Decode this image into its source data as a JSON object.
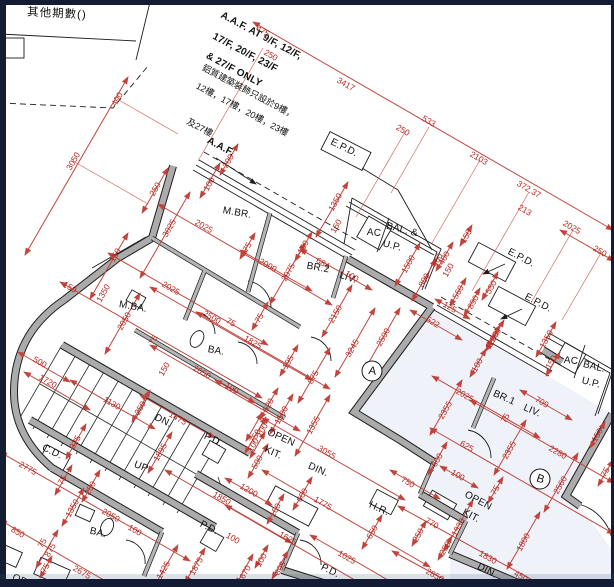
{
  "drawing": {
    "type": "architectural floor plan",
    "other_phases_title": "其他期數()",
    "colors": {
      "dimension_red": "#c0443c",
      "wall_gray": "#ababab",
      "frame_navy": "#131c33",
      "unit_b_tint": "#e9eef5"
    }
  },
  "labels": [
    {
      "name": "other-phases-title",
      "text": "其他期數()",
      "x": 57,
      "y": 13,
      "r": 3,
      "cls": "title"
    },
    {
      "name": "aaf-note-line1",
      "text": "A.A.F. AT 9/F, 12/F,",
      "x": 216,
      "y": 36,
      "r": 28,
      "cls": "note",
      "anchor": "l"
    },
    {
      "name": "aaf-note-line2",
      "text": "17/F, 20/F, 23/F",
      "x": 209,
      "y": 53,
      "r": 28,
      "cls": "note",
      "anchor": "l"
    },
    {
      "name": "aaf-note-line3",
      "text": "& 27/F ONLY",
      "x": 203,
      "y": 70,
      "r": 28,
      "cls": "note",
      "anchor": "l"
    },
    {
      "name": "aaf-note-cn1",
      "text": "鋁質建築裝飾只設於9樓，",
      "x": 197,
      "y": 91,
      "r": 28,
      "cls": "cn",
      "anchor": "l"
    },
    {
      "name": "aaf-note-cn2",
      "text": "12樓，17樓，20樓，23樓",
      "x": 191,
      "y": 109,
      "r": 28,
      "cls": "cn",
      "anchor": "l"
    },
    {
      "name": "aaf-note-cn3",
      "text": "及27樓",
      "x": 186,
      "y": 127,
      "r": 28,
      "cls": "cn",
      "anchor": "l"
    },
    {
      "name": "aaf-label",
      "text": "A.A.F.",
      "x": 206,
      "y": 147,
      "r": 28,
      "cls": "note",
      "anchor": "l"
    },
    {
      "name": "epd-label-top",
      "text": "E.P.D.",
      "x": 344,
      "y": 148,
      "r": 26,
      "cls": "room"
    },
    {
      "name": "epd-label-mid",
      "text": "E.P.D.",
      "x": 521,
      "y": 258,
      "r": 28,
      "cls": "room"
    },
    {
      "name": "epd-label-low",
      "text": "E.P.D.",
      "x": 538,
      "y": 303,
      "r": 28,
      "cls": "room"
    },
    {
      "name": "room-mbr",
      "text": "M.BR.",
      "x": 237,
      "y": 213,
      "r": 10,
      "cls": "room"
    },
    {
      "name": "room-br2",
      "text": "BR.2",
      "x": 318,
      "y": 268,
      "r": 10,
      "cls": "room"
    },
    {
      "name": "room-liv-a",
      "text": "LIV.",
      "x": 348,
      "y": 278,
      "r": 18,
      "cls": "room"
    },
    {
      "name": "room-ac-a",
      "text": "AC",
      "x": 374,
      "y": 233,
      "r": 5,
      "cls": "room"
    },
    {
      "name": "room-bal-a1",
      "text": "BAL. &",
      "x": 402,
      "y": 230,
      "r": 14,
      "cls": "room"
    },
    {
      "name": "room-bal-a2",
      "text": "U.P.",
      "x": 392,
      "y": 246,
      "r": 14,
      "cls": "room"
    },
    {
      "name": "room-mba",
      "text": "M.BA.",
      "x": 133,
      "y": 307,
      "r": 10,
      "cls": "room"
    },
    {
      "name": "room-ba-a",
      "text": "BA.",
      "x": 216,
      "y": 351,
      "r": 10,
      "cls": "room"
    },
    {
      "name": "stairs-dn",
      "text": "DN.",
      "x": 163,
      "y": 421,
      "r": 26,
      "cls": "room"
    },
    {
      "name": "stairs-up",
      "text": "UP",
      "x": 141,
      "y": 467,
      "r": 22,
      "cls": "room"
    },
    {
      "name": "cd-label",
      "text": "C.D.",
      "x": 52,
      "y": 452,
      "r": 26,
      "cls": "room"
    },
    {
      "name": "pd-label-a",
      "text": "P.D.",
      "x": 213,
      "y": 440,
      "r": 26,
      "cls": "room"
    },
    {
      "name": "open-kit-a1",
      "text": "OPEN",
      "x": 281,
      "y": 438,
      "r": 24,
      "cls": "room"
    },
    {
      "name": "open-kit-a2",
      "text": "KIT.",
      "x": 273,
      "y": 453,
      "r": 24,
      "cls": "room"
    },
    {
      "name": "din-a",
      "text": "DIN.",
      "x": 318,
      "y": 470,
      "r": 24,
      "cls": "room"
    },
    {
      "name": "pd-label-b",
      "text": "P.D.",
      "x": 209,
      "y": 528,
      "r": 26,
      "cls": "room"
    },
    {
      "name": "hr-label",
      "text": "H.R.",
      "x": 379,
      "y": 509,
      "r": 24,
      "cls": "room"
    },
    {
      "name": "pd-label-c",
      "text": "P.D.",
      "x": 330,
      "y": 571,
      "r": 26,
      "cls": "room"
    },
    {
      "name": "open-kit-b1",
      "text": "OPEN",
      "x": 478,
      "y": 501,
      "r": 28,
      "cls": "room"
    },
    {
      "name": "open-kit-b2",
      "text": "KIT.",
      "x": 471,
      "y": 516,
      "r": 28,
      "cls": "room"
    },
    {
      "name": "din-b",
      "text": "DIN.",
      "x": 487,
      "y": 571,
      "r": 28,
      "cls": "room"
    },
    {
      "name": "room-br1",
      "text": "BR.1",
      "x": 504,
      "y": 398,
      "r": 24,
      "cls": "room"
    },
    {
      "name": "room-liv-b",
      "text": "LIV.",
      "x": 532,
      "y": 411,
      "r": 24,
      "cls": "room"
    },
    {
      "name": "room-ac-b",
      "text": "AC",
      "x": 571,
      "y": 361,
      "r": 5,
      "cls": "room"
    },
    {
      "name": "room-bal-b1",
      "text": "BAL.",
      "x": 594,
      "y": 367,
      "r": 14,
      "cls": "room"
    },
    {
      "name": "room-bal-b2",
      "text": "U.P.",
      "x": 591,
      "y": 383,
      "r": 14,
      "cls": "room"
    },
    {
      "name": "room-ba-c",
      "text": "BA.",
      "x": 98,
      "y": 533,
      "r": 14,
      "cls": "room"
    },
    {
      "name": "open-partial",
      "text": "OPEN",
      "x": 26,
      "y": 583,
      "r": 24,
      "cls": "room"
    }
  ],
  "units": [
    {
      "name": "unit-a-badge",
      "label": "A",
      "x": 372,
      "y": 371,
      "r": 8
    },
    {
      "name": "unit-b-badge",
      "label": "B",
      "x": 540,
      "y": 479,
      "r": 18
    }
  ],
  "dims": [
    {
      "text": "475",
      "x": 263,
      "y": 31,
      "r": 30
    },
    {
      "text": "250",
      "x": 271,
      "y": 55,
      "r": 30
    },
    {
      "text": "3417",
      "x": 346,
      "y": 84,
      "r": 30
    },
    {
      "text": "250",
      "x": 403,
      "y": 130,
      "r": 30
    },
    {
      "text": "533",
      "x": 429,
      "y": 121,
      "r": 30
    },
    {
      "text": "2103",
      "x": 479,
      "y": 158,
      "r": 30
    },
    {
      "text": "372.37",
      "x": 529,
      "y": 189,
      "r": 30
    },
    {
      "text": "213",
      "x": 525,
      "y": 210,
      "r": 30
    },
    {
      "text": "2025",
      "x": 572,
      "y": 227,
      "r": 30
    },
    {
      "text": "250",
      "x": 600,
      "y": 251,
      "r": 30
    },
    {
      "text": "400",
      "x": 117,
      "y": 99,
      "r": -60
    },
    {
      "text": "3050",
      "x": 73,
      "y": 161,
      "r": -60
    },
    {
      "text": "200",
      "x": 228,
      "y": 161,
      "r": -60
    },
    {
      "text": "100",
      "x": 209,
      "y": 184,
      "r": -60
    },
    {
      "text": "250",
      "x": 155,
      "y": 189,
      "r": -60
    },
    {
      "text": "3025",
      "x": 169,
      "y": 228,
      "r": -60
    },
    {
      "text": "2025",
      "x": 204,
      "y": 226,
      "r": 30
    },
    {
      "text": "1350",
      "x": 335,
      "y": 202,
      "r": -60
    },
    {
      "text": "150",
      "x": 336,
      "y": 226,
      "r": -60
    },
    {
      "text": "150",
      "x": 303,
      "y": 247,
      "r": -60
    },
    {
      "text": "75",
      "x": 247,
      "y": 247,
      "r": -60
    },
    {
      "text": "2000",
      "x": 268,
      "y": 265,
      "r": 30
    },
    {
      "text": "2075",
      "x": 288,
      "y": 272,
      "r": -60
    },
    {
      "text": "684",
      "x": 323,
      "y": 263,
      "r": 30
    },
    {
      "text": "100",
      "x": 352,
      "y": 276,
      "r": 30
    },
    {
      "text": "1500",
      "x": 408,
      "y": 264,
      "r": -60
    },
    {
      "text": "800",
      "x": 424,
      "y": 280,
      "r": -60
    },
    {
      "text": "400",
      "x": 444,
      "y": 258,
      "r": -60
    },
    {
      "text": "150",
      "x": 448,
      "y": 270,
      "r": -60
    },
    {
      "text": "150",
      "x": 466,
      "y": 236,
      "r": -60
    },
    {
      "text": "560",
      "x": 458,
      "y": 292,
      "r": -60
    },
    {
      "text": "890",
      "x": 473,
      "y": 302,
      "r": -60
    },
    {
      "text": "550",
      "x": 491,
      "y": 287,
      "r": -60
    },
    {
      "text": "125",
      "x": 450,
      "y": 307,
      "r": 30
    },
    {
      "text": "1200",
      "x": 494,
      "y": 337,
      "r": -60
    },
    {
      "text": "1350",
      "x": 546,
      "y": 339,
      "r": -60
    },
    {
      "text": "150",
      "x": 551,
      "y": 362,
      "r": -60
    },
    {
      "text": "150",
      "x": 70,
      "y": 287,
      "r": 30
    },
    {
      "text": "150",
      "x": 115,
      "y": 255,
      "r": -60
    },
    {
      "text": "1350",
      "x": 103,
      "y": 293,
      "r": -60
    },
    {
      "text": "2050",
      "x": 124,
      "y": 321,
      "r": -60
    },
    {
      "text": "2025",
      "x": 171,
      "y": 288,
      "r": 30
    },
    {
      "text": "2500",
      "x": 212,
      "y": 317,
      "r": 30
    },
    {
      "text": "75",
      "x": 231,
      "y": 322,
      "r": 30
    },
    {
      "text": "75",
      "x": 153,
      "y": 340,
      "r": -60
    },
    {
      "text": "150",
      "x": 164,
      "y": 369,
      "r": -60
    },
    {
      "text": "2050",
      "x": 202,
      "y": 372,
      "r": 30
    },
    {
      "text": "1825",
      "x": 253,
      "y": 342,
      "r": 30
    },
    {
      "text": "75",
      "x": 259,
      "y": 318,
      "r": -60
    },
    {
      "text": "195",
      "x": 288,
      "y": 362,
      "r": -60
    },
    {
      "text": "875",
      "x": 313,
      "y": 377,
      "r": -60
    },
    {
      "text": "2150",
      "x": 335,
      "y": 314,
      "r": -60
    },
    {
      "text": "3245",
      "x": 352,
      "y": 348,
      "r": -60
    },
    {
      "text": "2500",
      "x": 383,
      "y": 337,
      "r": -60
    },
    {
      "text": "100",
      "x": 232,
      "y": 388,
      "r": 30
    },
    {
      "text": "620",
      "x": 268,
      "y": 405,
      "r": -60
    },
    {
      "text": "1500",
      "x": 281,
      "y": 415,
      "r": -60
    },
    {
      "text": "750",
      "x": 255,
      "y": 436,
      "r": -60
    },
    {
      "text": "1355",
      "x": 313,
      "y": 425,
      "r": -60
    },
    {
      "text": "522",
      "x": 433,
      "y": 322,
      "r": 30
    },
    {
      "text": "400",
      "x": 437,
      "y": 260,
      "r": -60
    },
    {
      "text": "500",
      "x": 40,
      "y": 362,
      "r": 30
    },
    {
      "text": "1720",
      "x": 48,
      "y": 381,
      "r": 30
    },
    {
      "text": "1130",
      "x": 112,
      "y": 403,
      "r": 30
    },
    {
      "text": "250",
      "x": 140,
      "y": 408,
      "r": -60
    },
    {
      "text": "1475",
      "x": 178,
      "y": 418,
      "r": 30
    },
    {
      "text": "325",
      "x": 75,
      "y": 442,
      "r": -60
    },
    {
      "text": "1895",
      "x": 160,
      "y": 452,
      "r": -60
    },
    {
      "text": "2775",
      "x": 28,
      "y": 468,
      "r": 30
    },
    {
      "text": "75",
      "x": 62,
      "y": 480,
      "r": -60
    },
    {
      "text": "250",
      "x": 90,
      "y": 488,
      "r": -60
    },
    {
      "text": "1350",
      "x": 72,
      "y": 508,
      "r": -60
    },
    {
      "text": "2050",
      "x": 111,
      "y": 515,
      "r": 30
    },
    {
      "text": "100",
      "x": 135,
      "y": 530,
      "r": 30
    },
    {
      "text": "850",
      "x": 18,
      "y": 532,
      "r": 30
    },
    {
      "text": "75",
      "x": 42,
      "y": 543,
      "r": -60
    },
    {
      "text": "875",
      "x": 50,
      "y": 550,
      "r": -60
    },
    {
      "text": "75",
      "x": 45,
      "y": 568,
      "r": -60
    },
    {
      "text": "2675",
      "x": 82,
      "y": 572,
      "r": 30
    },
    {
      "text": "1425",
      "x": 163,
      "y": 570,
      "r": -60
    },
    {
      "text": "1850",
      "x": 222,
      "y": 498,
      "r": 30
    },
    {
      "text": "1200",
      "x": 249,
      "y": 490,
      "r": 30
    },
    {
      "text": "100",
      "x": 262,
      "y": 430,
      "r": -60
    },
    {
      "text": "100",
      "x": 253,
      "y": 445,
      "r": -60
    },
    {
      "text": "500",
      "x": 257,
      "y": 462,
      "r": -60
    },
    {
      "text": "100",
      "x": 275,
      "y": 510,
      "r": -60
    },
    {
      "text": "600",
      "x": 302,
      "y": 495,
      "r": -60
    },
    {
      "text": "3055",
      "x": 327,
      "y": 452,
      "r": 30
    },
    {
      "text": "1775",
      "x": 323,
      "y": 503,
      "r": 30
    },
    {
      "text": "1625",
      "x": 288,
      "y": 538,
      "r": 30
    },
    {
      "text": "1025",
      "x": 347,
      "y": 557,
      "r": 30
    },
    {
      "text": "650",
      "x": 372,
      "y": 532,
      "r": -60
    },
    {
      "text": "1875",
      "x": 196,
      "y": 566,
      "r": -60
    },
    {
      "text": "670",
      "x": 245,
      "y": 572,
      "r": -60
    },
    {
      "text": "805",
      "x": 280,
      "y": 568,
      "r": -60
    },
    {
      "text": "100",
      "x": 261,
      "y": 560,
      "r": -60
    },
    {
      "text": "2355",
      "x": 445,
      "y": 410,
      "r": -60
    },
    {
      "text": "2025",
      "x": 465,
      "y": 395,
      "r": 30
    },
    {
      "text": "2355",
      "x": 509,
      "y": 450,
      "r": -60
    },
    {
      "text": "709",
      "x": 542,
      "y": 402,
      "r": 30
    },
    {
      "text": "75",
      "x": 505,
      "y": 418,
      "r": -60
    },
    {
      "text": "2280",
      "x": 558,
      "y": 452,
      "r": 30
    },
    {
      "text": "2560",
      "x": 560,
      "y": 485,
      "r": -60
    },
    {
      "text": "100",
      "x": 477,
      "y": 365,
      "r": -60
    },
    {
      "text": "1200",
      "x": 492,
      "y": 340,
      "r": -60
    },
    {
      "text": "625",
      "x": 467,
      "y": 446,
      "r": 30
    },
    {
      "text": "600",
      "x": 437,
      "y": 460,
      "r": -60
    },
    {
      "text": "750",
      "x": 408,
      "y": 482,
      "r": 30
    },
    {
      "text": "100",
      "x": 458,
      "y": 475,
      "r": 30
    },
    {
      "text": "75",
      "x": 495,
      "y": 490,
      "r": -60
    },
    {
      "text": "150",
      "x": 597,
      "y": 435,
      "r": -60
    },
    {
      "text": "75",
      "x": 605,
      "y": 472,
      "r": -60
    },
    {
      "text": "770",
      "x": 432,
      "y": 523,
      "r": 30
    },
    {
      "text": "250",
      "x": 418,
      "y": 535,
      "r": -60
    },
    {
      "text": "250",
      "x": 445,
      "y": 548,
      "r": -60
    },
    {
      "text": "1930",
      "x": 458,
      "y": 527,
      "r": -60
    },
    {
      "text": "1830",
      "x": 488,
      "y": 557,
      "r": 30
    },
    {
      "text": "1800",
      "x": 523,
      "y": 542,
      "r": -60
    },
    {
      "text": "2850",
      "x": 435,
      "y": 575,
      "r": 30
    },
    {
      "text": "450",
      "x": 521,
      "y": 576,
      "r": 30
    },
    {
      "text": "100",
      "x": 233,
      "y": 538,
      "r": 30
    }
  ]
}
